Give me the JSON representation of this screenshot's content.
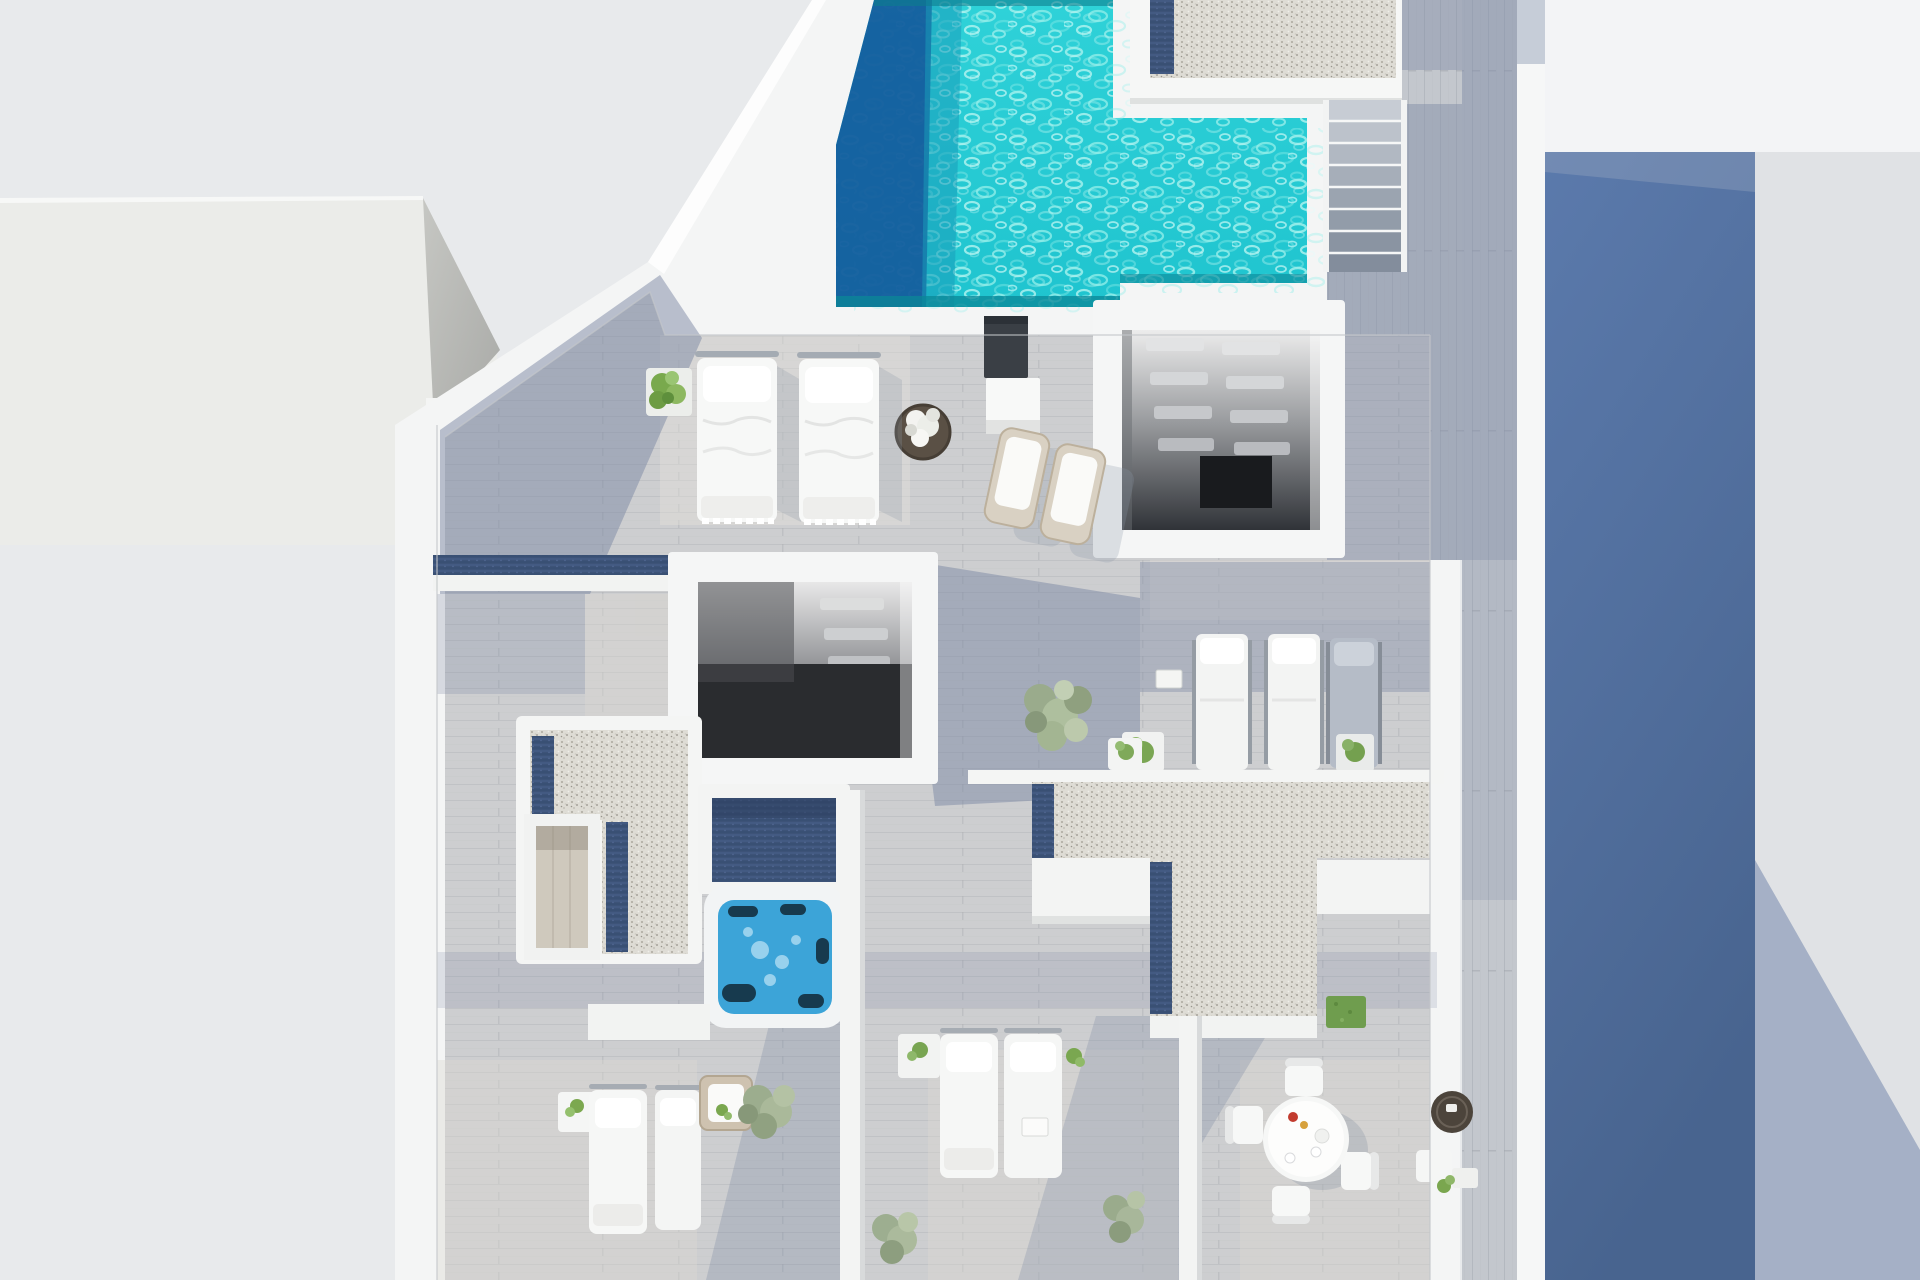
{
  "scene": {
    "title": "Aerial top-down 3D render of a rooftop terrace with swimming pool",
    "type": "architectural-visualization",
    "view": "top-down",
    "canvas": {
      "width": 1920,
      "height": 1280
    }
  },
  "palette": {
    "background": "#e8eaec",
    "background_right": "#e0e2e5",
    "background_top_right": "#f3f4f6",
    "shadow_band_blue": "#52709f",
    "shadow_wedge": "#7d90b0",
    "neighbor_roof": "#ebece9",
    "neighbor_roof_side": "#b9bab7",
    "navy_tile": "#3d5378",
    "wall_white": "#f4f5f5",
    "deck_wood": "#cdced0",
    "deck_shadow": "#7b88a3",
    "deck_sunlit": "#ddd9d2",
    "corridor_wood": "#c3c7cd",
    "pool_water": "#28ccd4",
    "pool_ripple": "#9ff0ec",
    "pool_shadow": "#155f9e",
    "pool_edge_dark": "#0b8797",
    "gravel": "#dedcd5",
    "gravel_speckle": "#a5a29a",
    "stair_tread": "#9aa5b4",
    "stairwell_dark": "#2a2c2f",
    "hot_tub_water": "#3ca4d8",
    "plant_green": "#79a94d",
    "plant_sage": "#9cad8e",
    "rattan": "#d9d1c3",
    "furniture_white": "#f6f7f6",
    "chrome": "#a4abb3"
  },
  "objects": [
    {
      "id": "neighbor-building-roof",
      "label": "Neighbouring building flat roof",
      "region": {
        "x": 0,
        "y": 198,
        "w": 497,
        "h": 345
      }
    },
    {
      "id": "navy-wall-corner",
      "label": "Navy tiled wall corner",
      "region": {
        "x": 436,
        "y": 402,
        "w": 46,
        "h": 144
      }
    },
    {
      "id": "swimming-pool",
      "label": "Swimming pool with rippled turquoise water",
      "region": {
        "x": 836,
        "y": 0,
        "w": 471,
        "h": 307
      }
    },
    {
      "id": "pool-shadow-band",
      "label": "Shadow band on pool water",
      "region": {
        "x": 836,
        "y": 0,
        "w": 96,
        "h": 307
      }
    },
    {
      "id": "gravel-roof-box",
      "label": "Gravel-topped roof box beside pool",
      "region": {
        "x": 1130,
        "y": 0,
        "w": 272,
        "h": 104
      }
    },
    {
      "id": "exterior-staircase",
      "label": "Exterior staircase to lower deck",
      "region": {
        "x": 1327,
        "y": 100,
        "w": 80,
        "h": 172
      }
    },
    {
      "id": "ne-stairwell",
      "label": "Open stairwell with floating treads",
      "region": {
        "x": 1093,
        "y": 300,
        "w": 252,
        "h": 258
      }
    },
    {
      "id": "center-stairwell",
      "label": "Central open stairwell",
      "region": {
        "x": 668,
        "y": 552,
        "w": 270,
        "h": 232
      }
    },
    {
      "id": "outdoor-shower",
      "label": "Outdoor shower panel",
      "region": {
        "x": 984,
        "y": 316,
        "w": 56,
        "h": 118
      }
    },
    {
      "id": "round-planter",
      "label": "Round planter with white plant",
      "region": {
        "x": 896,
        "y": 403,
        "w": 54,
        "h": 54
      }
    },
    {
      "id": "double-sunbeds",
      "label": "Two white sun beds with duvet cushions",
      "region": {
        "x": 697,
        "y": 351,
        "w": 181,
        "h": 175
      }
    },
    {
      "id": "pool-bush",
      "label": "Green bush in white planter",
      "region": {
        "x": 646,
        "y": 368,
        "w": 46,
        "h": 48
      }
    },
    {
      "id": "rattan-loungers",
      "label": "Two rattan loungers with towels",
      "region": {
        "x": 990,
        "y": 426,
        "w": 130,
        "h": 120
      }
    },
    {
      "id": "lounger-trio",
      "label": "Row of three sun loungers",
      "region": {
        "x": 1192,
        "y": 634,
        "w": 186,
        "h": 136
      }
    },
    {
      "id": "trio-planters",
      "label": "Planters flanking lounger row",
      "region": {
        "x": 1122,
        "y": 732,
        "w": 252,
        "h": 42
      }
    },
    {
      "id": "center-plant",
      "label": "Large potted plant with side table",
      "region": {
        "x": 1030,
        "y": 686,
        "w": 120,
        "h": 84
      }
    },
    {
      "id": "navy-parapet-band",
      "label": "Navy tiled parapet band",
      "region": {
        "x": 433,
        "y": 555,
        "w": 246,
        "h": 36
      }
    },
    {
      "id": "gravel-l-west",
      "label": "L-shaped gravel roof patch (west)",
      "region": {
        "x": 516,
        "y": 716,
        "w": 186,
        "h": 248
      }
    },
    {
      "id": "skylight-lightwell",
      "label": "Light well showing floor below",
      "region": {
        "x": 524,
        "y": 814,
        "w": 76,
        "h": 146
      }
    },
    {
      "id": "hot-tub",
      "label": "Hot tub / jacuzzi",
      "region": {
        "x": 704,
        "y": 886,
        "w": 142,
        "h": 142
      }
    },
    {
      "id": "jacuzzi-deck",
      "label": "Navy tiled deck beside hot tub",
      "region": {
        "x": 698,
        "y": 784,
        "w": 152,
        "h": 110
      }
    },
    {
      "id": "gravel-t-center",
      "label": "T-shaped gravel roof patch (center)",
      "region": {
        "x": 1032,
        "y": 782,
        "w": 398,
        "h": 234
      }
    },
    {
      "id": "privacy-divider-1",
      "label": "White privacy divider wall",
      "region": {
        "x": 840,
        "y": 790,
        "w": 22,
        "h": 490
      }
    },
    {
      "id": "privacy-divider-2",
      "label": "White privacy divider wall",
      "region": {
        "x": 1179,
        "y": 1016,
        "w": 20,
        "h": 264
      }
    },
    {
      "id": "bay1-loungers",
      "label": "Two sun loungers (west bay)",
      "region": {
        "x": 589,
        "y": 1084,
        "w": 112,
        "h": 150
      }
    },
    {
      "id": "bay1-armchair",
      "label": "Wicker armchair",
      "region": {
        "x": 700,
        "y": 1076,
        "w": 52,
        "h": 54
      }
    },
    {
      "id": "bay2-loungers",
      "label": "Two sun loungers (center bay)",
      "region": {
        "x": 940,
        "y": 1032,
        "w": 122,
        "h": 146
      }
    },
    {
      "id": "dining-set",
      "label": "Round dining table with four chairs",
      "region": {
        "x": 1225,
        "y": 1058,
        "w": 160,
        "h": 160
      }
    },
    {
      "id": "wicker-side-table",
      "label": "Dark wicker side table",
      "region": {
        "x": 1431,
        "y": 1091,
        "w": 42,
        "h": 42
      }
    },
    {
      "id": "grass-patch",
      "label": "Artificial grass patch",
      "region": {
        "x": 1326,
        "y": 996,
        "w": 40,
        "h": 32
      }
    },
    {
      "id": "corridor-deck",
      "label": "Side corridor wood deck in shadow",
      "region": {
        "x": 1397,
        "y": 0,
        "w": 120,
        "h": 1280
      }
    },
    {
      "id": "shadow-band",
      "label": "Building shadow cast on neighbour plot",
      "region": {
        "x": 1545,
        "y": 152,
        "w": 210,
        "h": 1128
      }
    },
    {
      "id": "west-parapet",
      "label": "West parapet wall",
      "region": {
        "x": 395,
        "y": 425,
        "w": 42,
        "h": 855
      }
    },
    {
      "id": "east-wall",
      "label": "East boundary wall",
      "region": {
        "x": 1517,
        "y": 0,
        "w": 28,
        "h": 1280
      }
    }
  ]
}
